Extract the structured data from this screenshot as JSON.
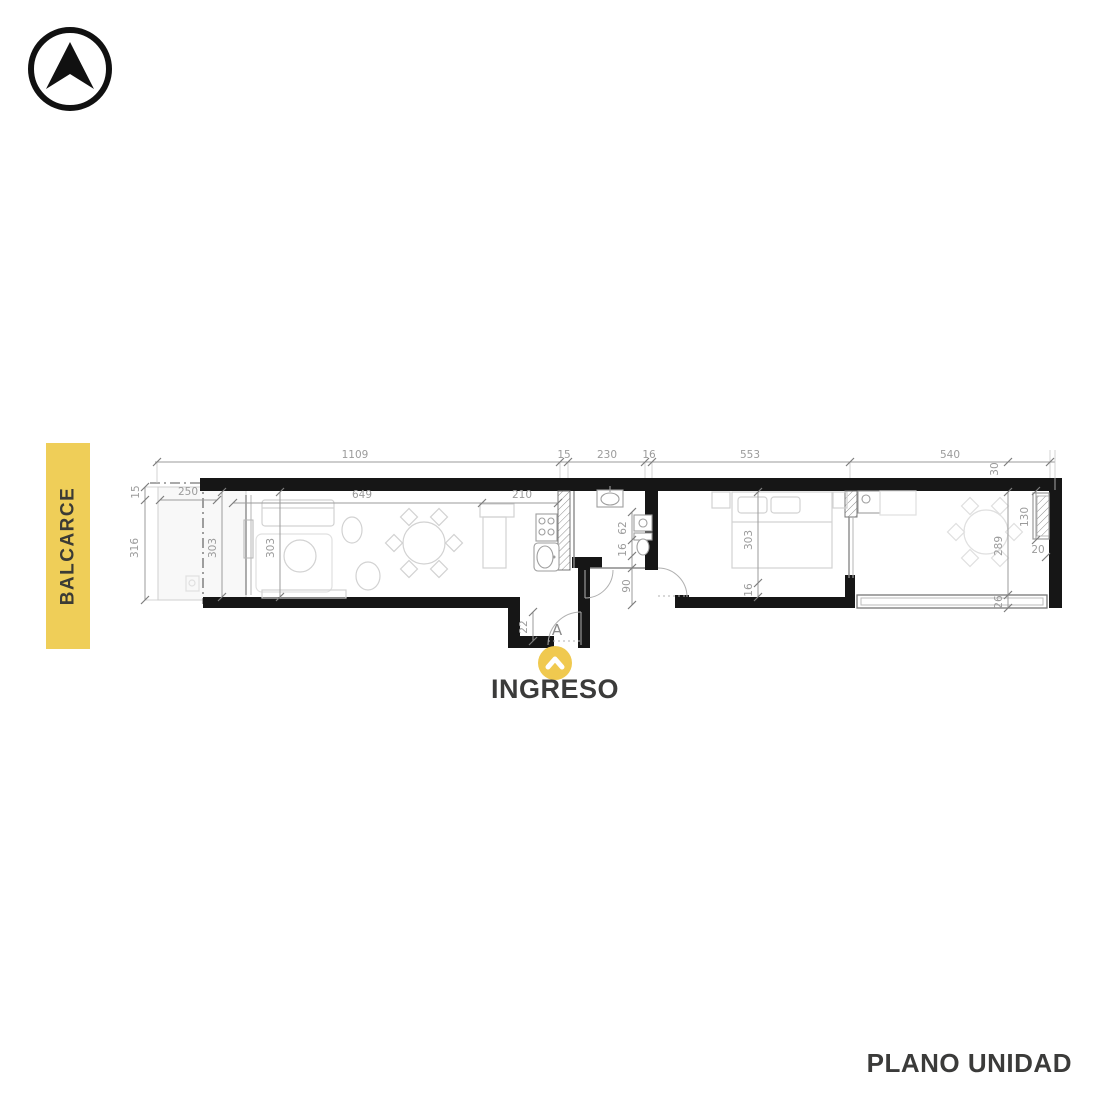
{
  "logo": {
    "name": "north-arrow-compass"
  },
  "banner": {
    "label": "BALCARCE",
    "color": "#EFCE58"
  },
  "entrance": {
    "label": "INGRESO",
    "marker_color": "#F0C94F"
  },
  "footer": {
    "title": "PLANO UNIDAD"
  },
  "plan": {
    "entry_door_label": "A",
    "dims": {
      "top": [
        "1109",
        "15",
        "230",
        "16",
        "553",
        "540"
      ],
      "top_wall": "30",
      "left": {
        "wall": "15",
        "depth": "316",
        "width": "250"
      },
      "living": {
        "length": "649",
        "kitchen": "210",
        "depth_a": "303",
        "depth_b": "303"
      },
      "bath": {
        "a": "62",
        "b": "16",
        "hall": "90"
      },
      "bedroom": {
        "depth": "303",
        "wall": "16"
      },
      "terrace": {
        "depth": "289",
        "bench_length": "130",
        "bench_width": "20",
        "rail": "26"
      },
      "entry": {
        "step": "22"
      }
    },
    "colors": {
      "wall": "#161616",
      "dim_text": "#9b9b9b"
    }
  }
}
